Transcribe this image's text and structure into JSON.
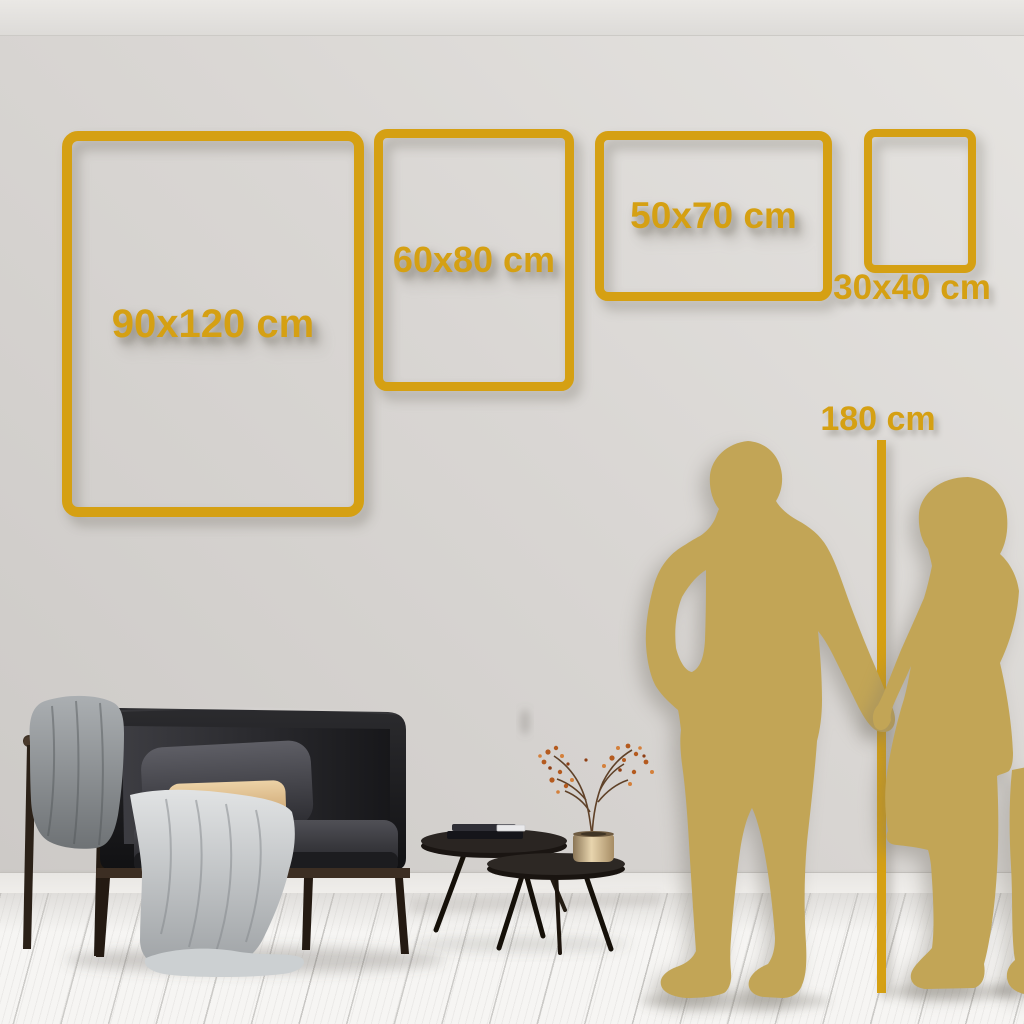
{
  "size_guide": {
    "unit": "cm",
    "frames": [
      {
        "label": "90x120 cm",
        "width_cm": 90,
        "height_cm": 120
      },
      {
        "label": "60x80 cm",
        "width_cm": 60,
        "height_cm": 80
      },
      {
        "label": "50x70 cm",
        "width_cm": 50,
        "height_cm": 70
      },
      {
        "label": "30x40 cm",
        "width_cm": 30,
        "height_cm": 40
      }
    ],
    "height_reference": {
      "label": "180 cm",
      "value_cm": 180
    }
  },
  "colors": {
    "accent_gold": "#D5A013",
    "silhouette_gold": "#C2A556",
    "wall": "#D8D5D2",
    "floor": "#F6F5F3"
  },
  "scene": {
    "objects": [
      "sofa",
      "gray-throw-blanket",
      "light-throw-blanket",
      "dark-pillow",
      "tan-pillow",
      "nesting-coffee-tables",
      "books",
      "brass-vase",
      "dried-branch-plant",
      "man-silhouette",
      "woman-silhouette",
      "height-reference-line"
    ]
  }
}
